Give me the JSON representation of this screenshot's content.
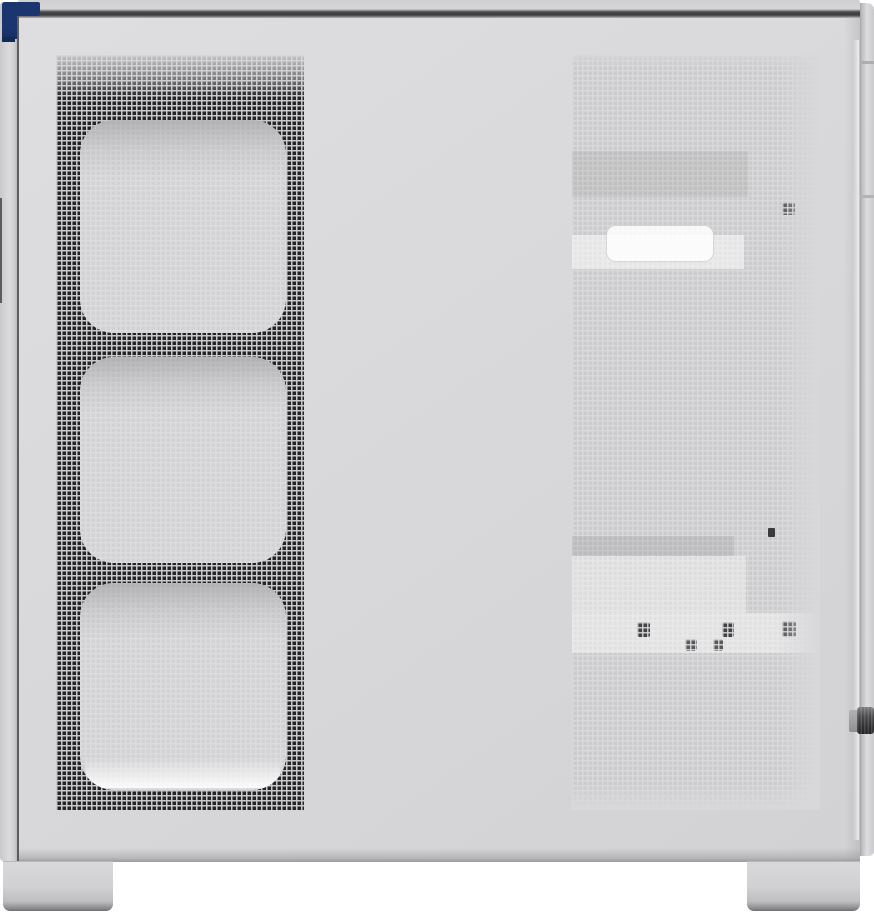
{
  "scene": {
    "type": "product-photo",
    "subject": "white-pc-case-side-view",
    "description": "Side view of a white mid-tower PC case: perforated front mesh strip with three fan cutouts, large perforated side vent panel, navy front corner accent, rear panel edge with thumbscrew, and two case feet",
    "visible_text": []
  },
  "theme": {
    "bg": "#ffffff",
    "body": "#d8d8da",
    "accent": "#1b356e",
    "accent_dark": "#122a56",
    "mesh_dark": "#242426",
    "web_dark": "#c9c9cb",
    "mesh_light": "#cbcbcd",
    "web_light": "#d9d9db",
    "mesh_faint": "#d2d2d5",
    "web_faint": "#dcdcde",
    "knob": "#3a3a3c"
  },
  "details": {
    "fan_cutouts": 3,
    "feet": 2,
    "thumbscrews": 1,
    "screw_clusters_in_lower_vent": 5
  }
}
